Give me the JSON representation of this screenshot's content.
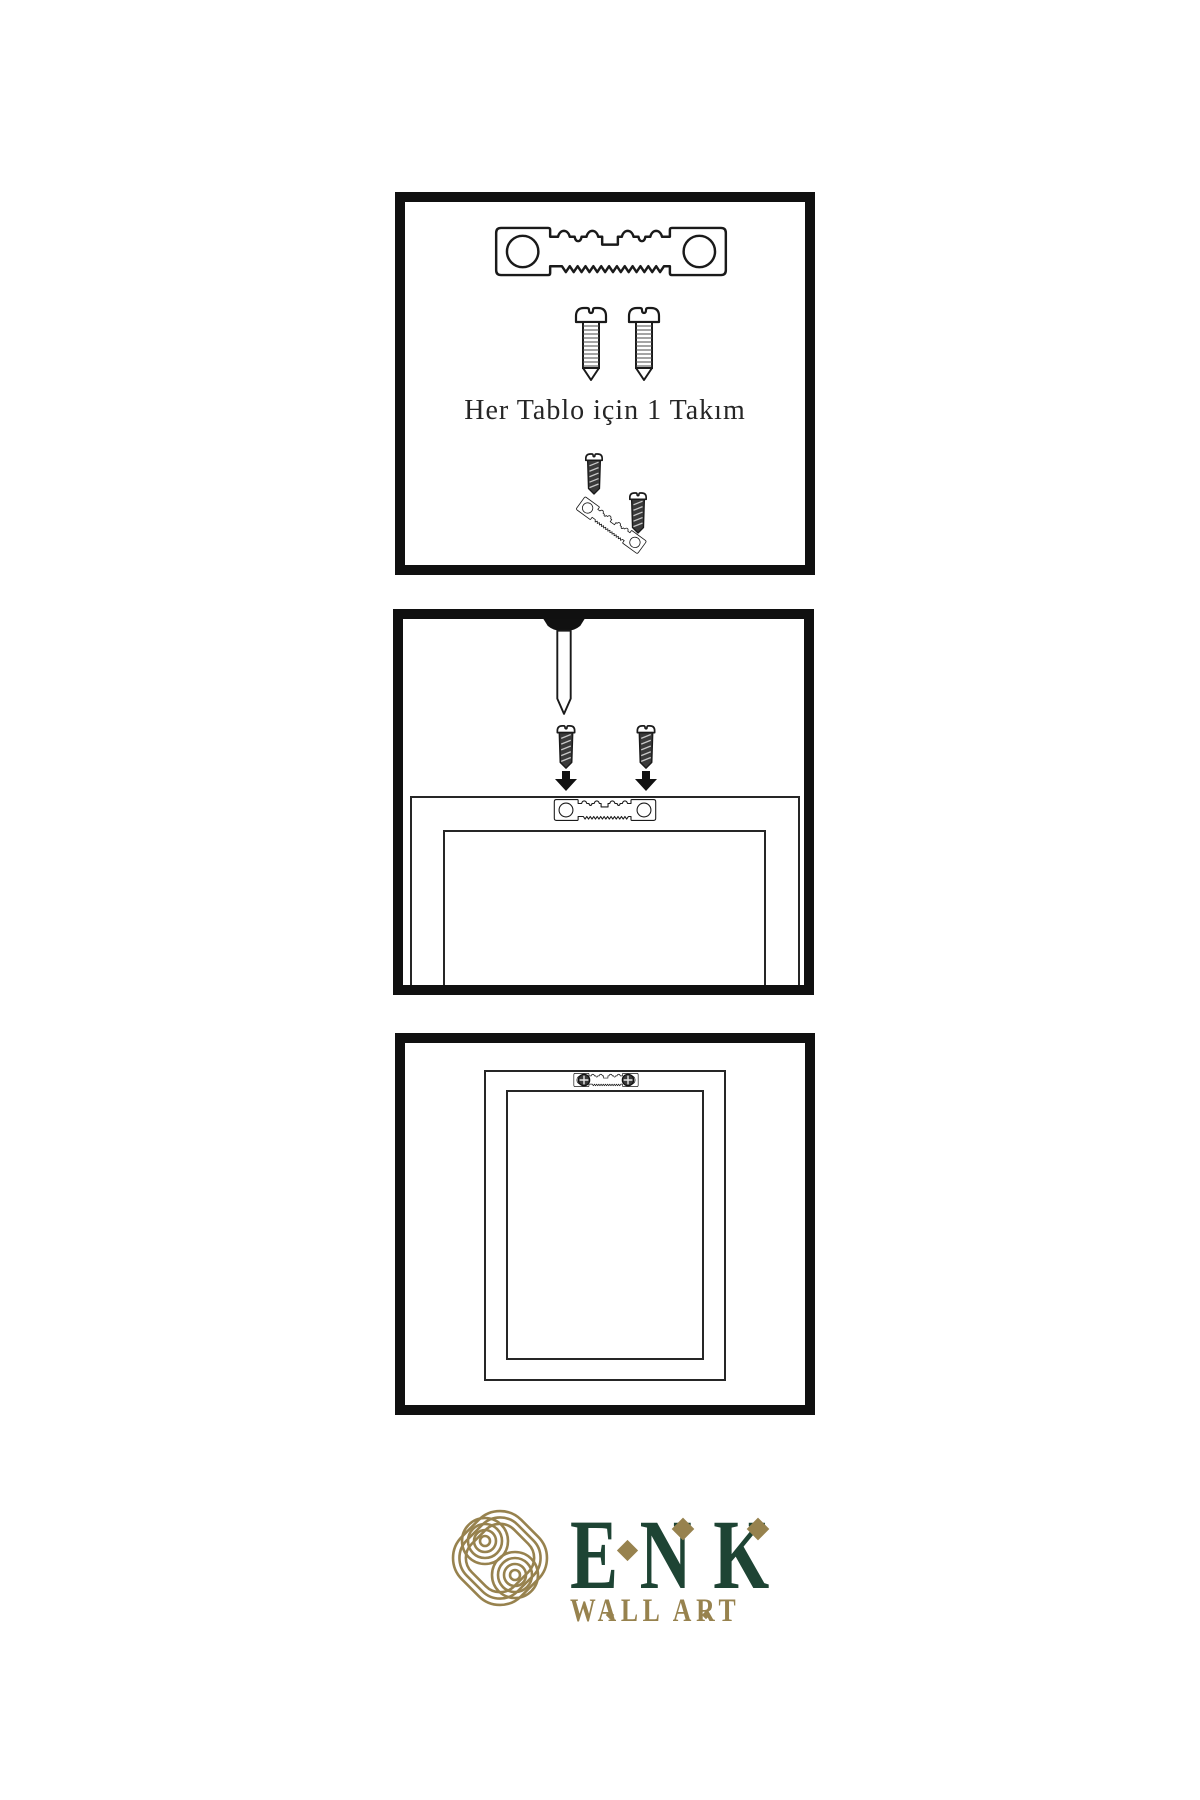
{
  "colors": {
    "background": "#ffffff",
    "ink": "#141414",
    "line": "#262626",
    "screw_fill": "#3a3a3a",
    "brand_green": "#1e4434",
    "brand_gold": "#97824e"
  },
  "panels": [
    {
      "name": "hardware-kit",
      "caption": "Her Tablo için 1 Takım",
      "items": [
        "sawtooth-hanger",
        "mounting-screw",
        "mounting-screw",
        "screw-driven-into-tilted-hanger"
      ]
    },
    {
      "name": "wall-installation",
      "items": [
        "wall-nail",
        "screw-with-down-arrow",
        "screw-with-down-arrow",
        "frame-back-with-sawtooth-hanger"
      ]
    },
    {
      "name": "hanging-result",
      "items": [
        "frame-back",
        "mounted-sawtooth-hanger-with-screws"
      ]
    }
  ],
  "logo": {
    "brand": "ENK",
    "subtitle": "WALL ART"
  }
}
